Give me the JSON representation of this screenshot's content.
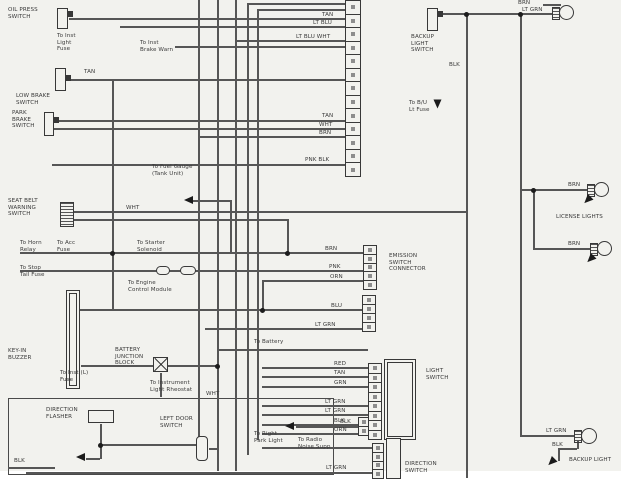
{
  "diagram_type": "automotive wiring diagram",
  "colors": {
    "background": "#f2f2ee",
    "margin": "#ffffff",
    "wire": "#565656",
    "component_outline": "#383838",
    "text": "#3a3a3a"
  },
  "icons": {
    "ground_arrow": "filled triangle",
    "junction_dot": "filled circle",
    "lamp": "circle with hatched connector",
    "connector": "segmented cell strip"
  },
  "labels": {
    "oil_press_switch": "OIL PRESS\nSWITCH",
    "to_inst_light_fuse": "To Inst\nLight\nFuse",
    "to_inst_brake_warn": "To Inst\nBrake Warn",
    "tan_top": "TAN",
    "lt_blu_top": "LT BLU",
    "lt_blu_wht": "LT BLU WHT",
    "tan_low_brake": "TAN",
    "low_brake_switch": "LOW BRAKE\nSWITCH",
    "park_brake_switch": "PARK\nBRAKE\nSWITCH",
    "tan_mid": "TAN",
    "wht_mid": "WHT",
    "brn_mid": "BRN",
    "pnk_blk": "PNK BLK",
    "to_fuel_gauge": "To Fuel Gauge\n(Tank Unit)",
    "seat_belt_switch": "SEAT BELT\nWARNING\nSWITCH",
    "wht_seat": "WHT",
    "to_horn_relay": "To Horn\nRelay",
    "to_acc_fuse": "To Acc\nFuse",
    "to_starter_solenoid": "To Starter\nSolenoid",
    "to_stop_tail": "To Stop\nTail Fuse",
    "to_engine_cm": "To Engine\nControl Module",
    "key_in_buzzer": "KEY-IN\nBUZZER",
    "to_inst_fuse": "To Inst (L)\nFuse",
    "battery_junction": "BATTERY\nJUNCTION\nBLOCK",
    "to_inst_rheostat": "To Instrument\nLight Rheostat",
    "wht_rheostat": "WHT",
    "to_battery": "To Battery",
    "left_door_switch": "LEFT DOOR\nSWITCH",
    "direction_flasher": "DIRECTION\nFLASHER",
    "blk_flasher": "BLK",
    "brn_emission": "BRN",
    "pnk_emission": "PNK",
    "orn_emission": "ORN",
    "blu_emission": "BLU",
    "lt_grn_emission": "LT GRN",
    "emission_connector": "EMISSION\nSWITCH\nCONNECTOR",
    "light_switch": "LIGHT\nSWITCH",
    "ls_red": "RED",
    "ls_tan": "TAN",
    "ls_grn": "GRN",
    "ls_ltgrn1": "LT GRN",
    "ls_ltgrn2": "LT GRN",
    "ls_blk": "BLK",
    "ls_orn": "ORN",
    "direction_switch": "DIRECTION\nSWITCH",
    "to_right_park": "To Right\nPark Light",
    "to_radio": "To Radio\nNoise Supp",
    "blk_bottom": "BLK",
    "lt_grn_bottom": "LT GRN",
    "backup_light_switch": "BACKUP\nLIGHT\nSWITCH",
    "blk_backup": "BLK",
    "to_bu_light": "To B/U\nLt Fuse",
    "brn_lamp_top": "BRN",
    "lt_grn_lamp_top": "LT GRN",
    "license_lights": "LICENSE LIGHTS",
    "brn_license1": "BRN",
    "brn_license2": "BRN",
    "backup_light": "BACKUP LIGHT",
    "lt_grn_backup": "LT GRN",
    "blk_backup2": "BLK"
  }
}
